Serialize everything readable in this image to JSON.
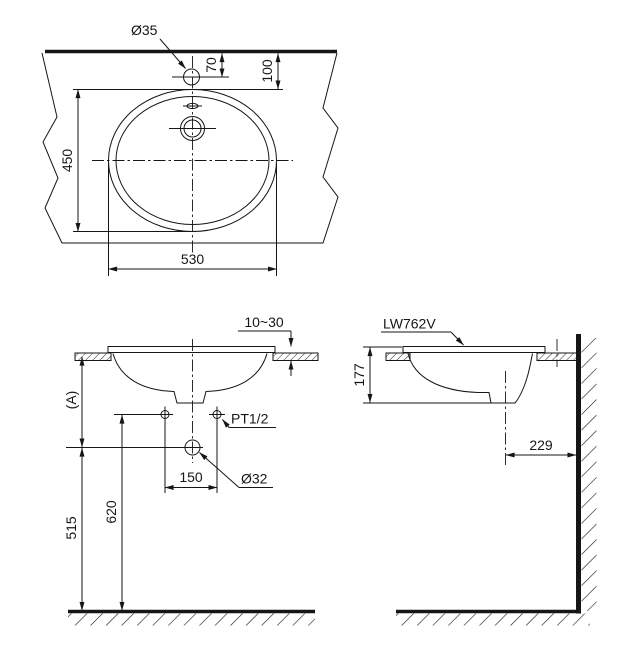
{
  "drawing": {
    "ink_color": "#161616",
    "background_color": "#ffffff",
    "plan_view": {
      "faucet_hole_diameter": "Ø35",
      "faucet_center_offset": "70",
      "rim_offset_from_wall": "100",
      "basin_front_to_back": "450",
      "basin_width": "530"
    },
    "front_view": {
      "rim_above_counter_range": "10~30",
      "counter_height_label": "(A)",
      "supply_connection": "PT1/2",
      "supply_spacing": "150",
      "drain_diameter": "Ø32",
      "supply_height_from_floor": "620",
      "drain_height_from_floor": "515"
    },
    "side_view": {
      "model_code": "LW762V",
      "bowl_depth": "177",
      "drain_center_to_wall": "229"
    }
  }
}
